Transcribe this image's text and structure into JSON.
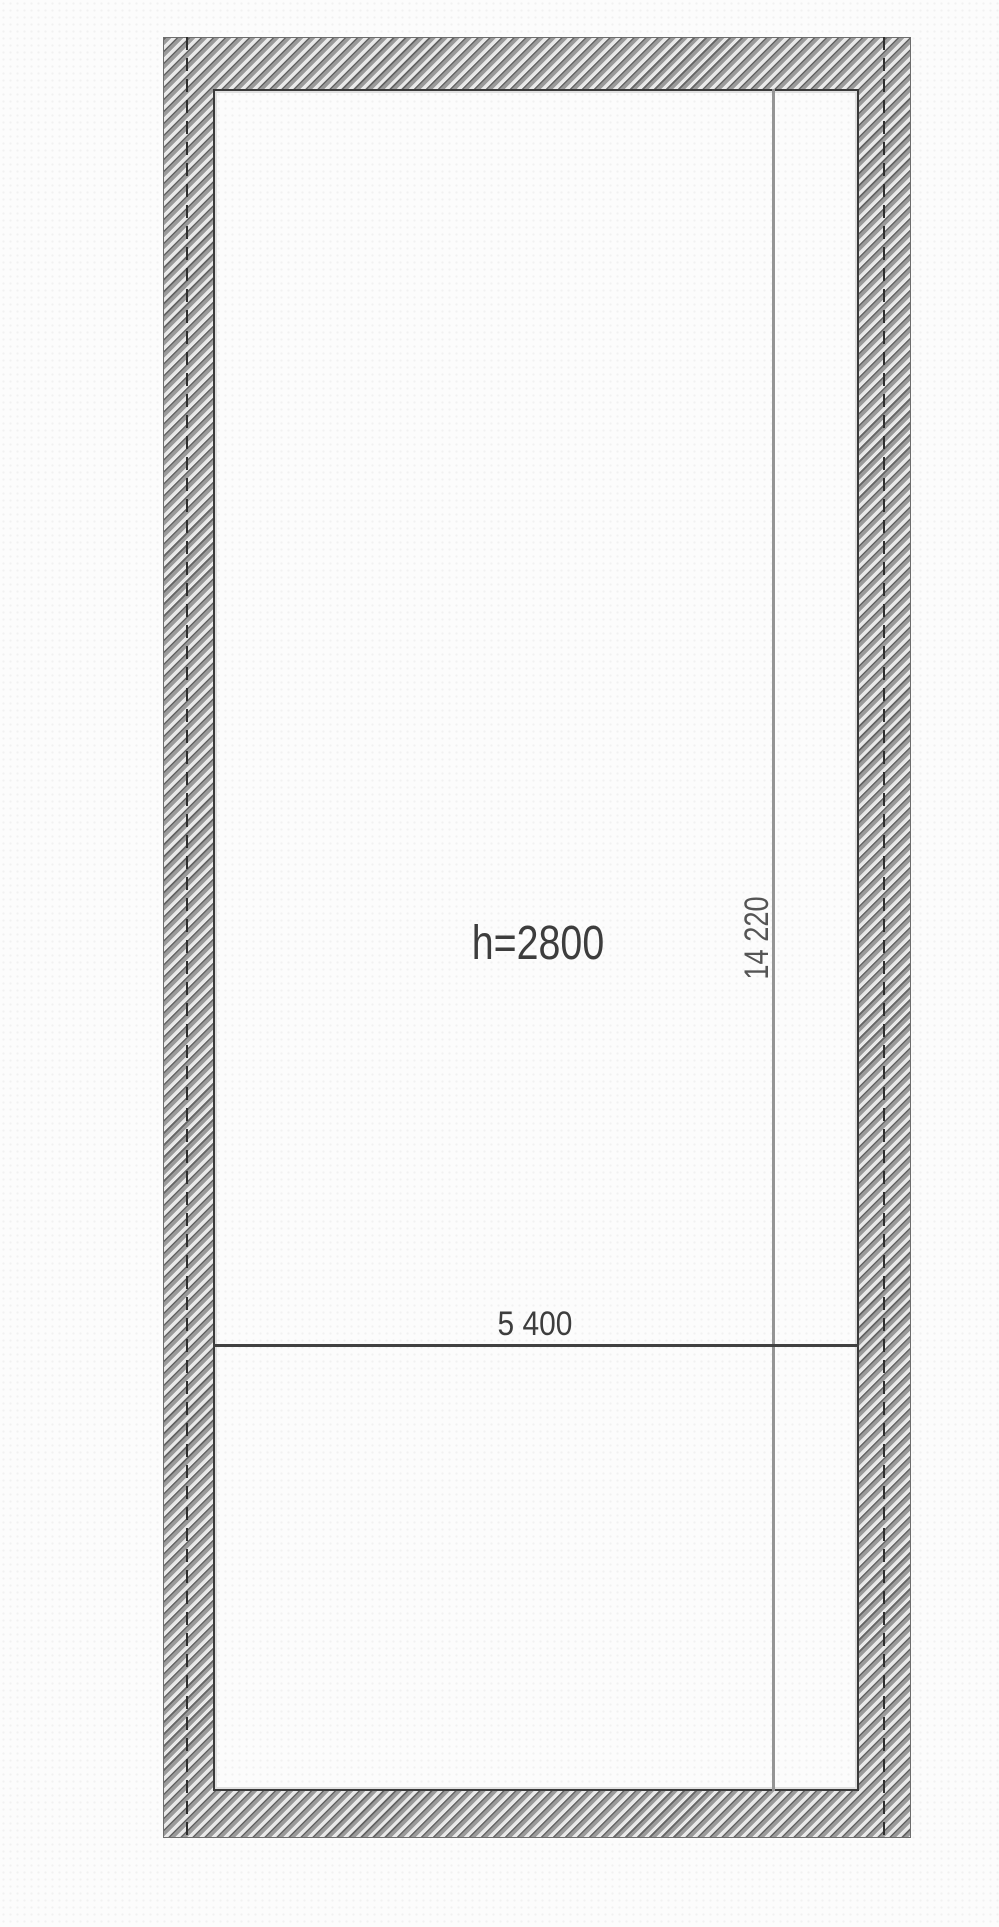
{
  "plan": {
    "kind": "room-floor-plan",
    "labels": {
      "ceiling_height": "h=2800",
      "room_width": "5 400",
      "room_length": "14 220"
    },
    "values": {
      "ceiling_height_mm": 2800,
      "room_width_mm": 5400,
      "room_length_mm": 14220
    },
    "colors": {
      "background": "#fcfcfc",
      "wall_hatch_dark": "#646464",
      "wall_hatch_mid": "#9a9a9a",
      "wall_hatch_light": "#e9e9e9",
      "wall_outer_edge": "#6e6e6e",
      "wall_inner_edge": "#3a3a3a",
      "axis_line": "#2f2f2f",
      "dim_line_vertical": "#949494",
      "dim_line_horizontal": "#414141",
      "text": "#3d3d3d"
    }
  }
}
